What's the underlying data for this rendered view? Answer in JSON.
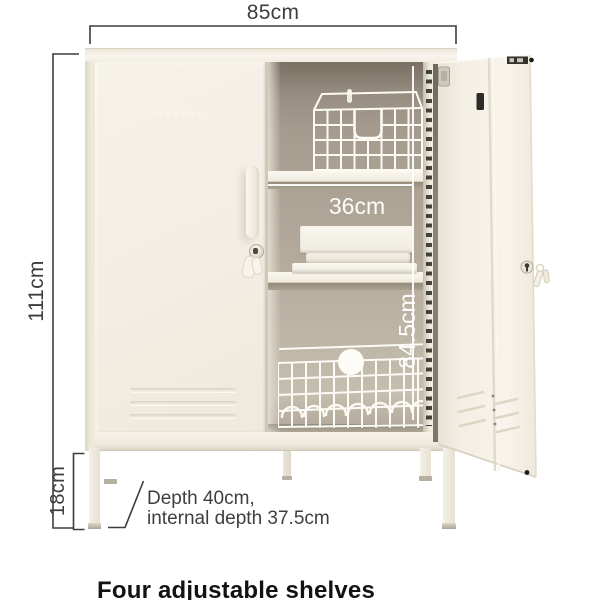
{
  "cabinet": {
    "logo": "mustard",
    "caption": "Four adjustable shelves"
  },
  "dimensions": {
    "external_width": "85cm",
    "external_height": "111cm",
    "leg_height": "18cm",
    "internal_shelf_width": "36cm",
    "internal_height": "84.5cm",
    "depth_note_line1": "Depth 40cm,",
    "depth_note_line2": "internal depth 37.5cm"
  },
  "colors": {
    "background": "#ffffff",
    "cabinet_cream": "#f3eee4",
    "interior_taupe": "#ada495",
    "annotation_text": "#3e3e3e",
    "measurement_white": "#ffffff"
  }
}
